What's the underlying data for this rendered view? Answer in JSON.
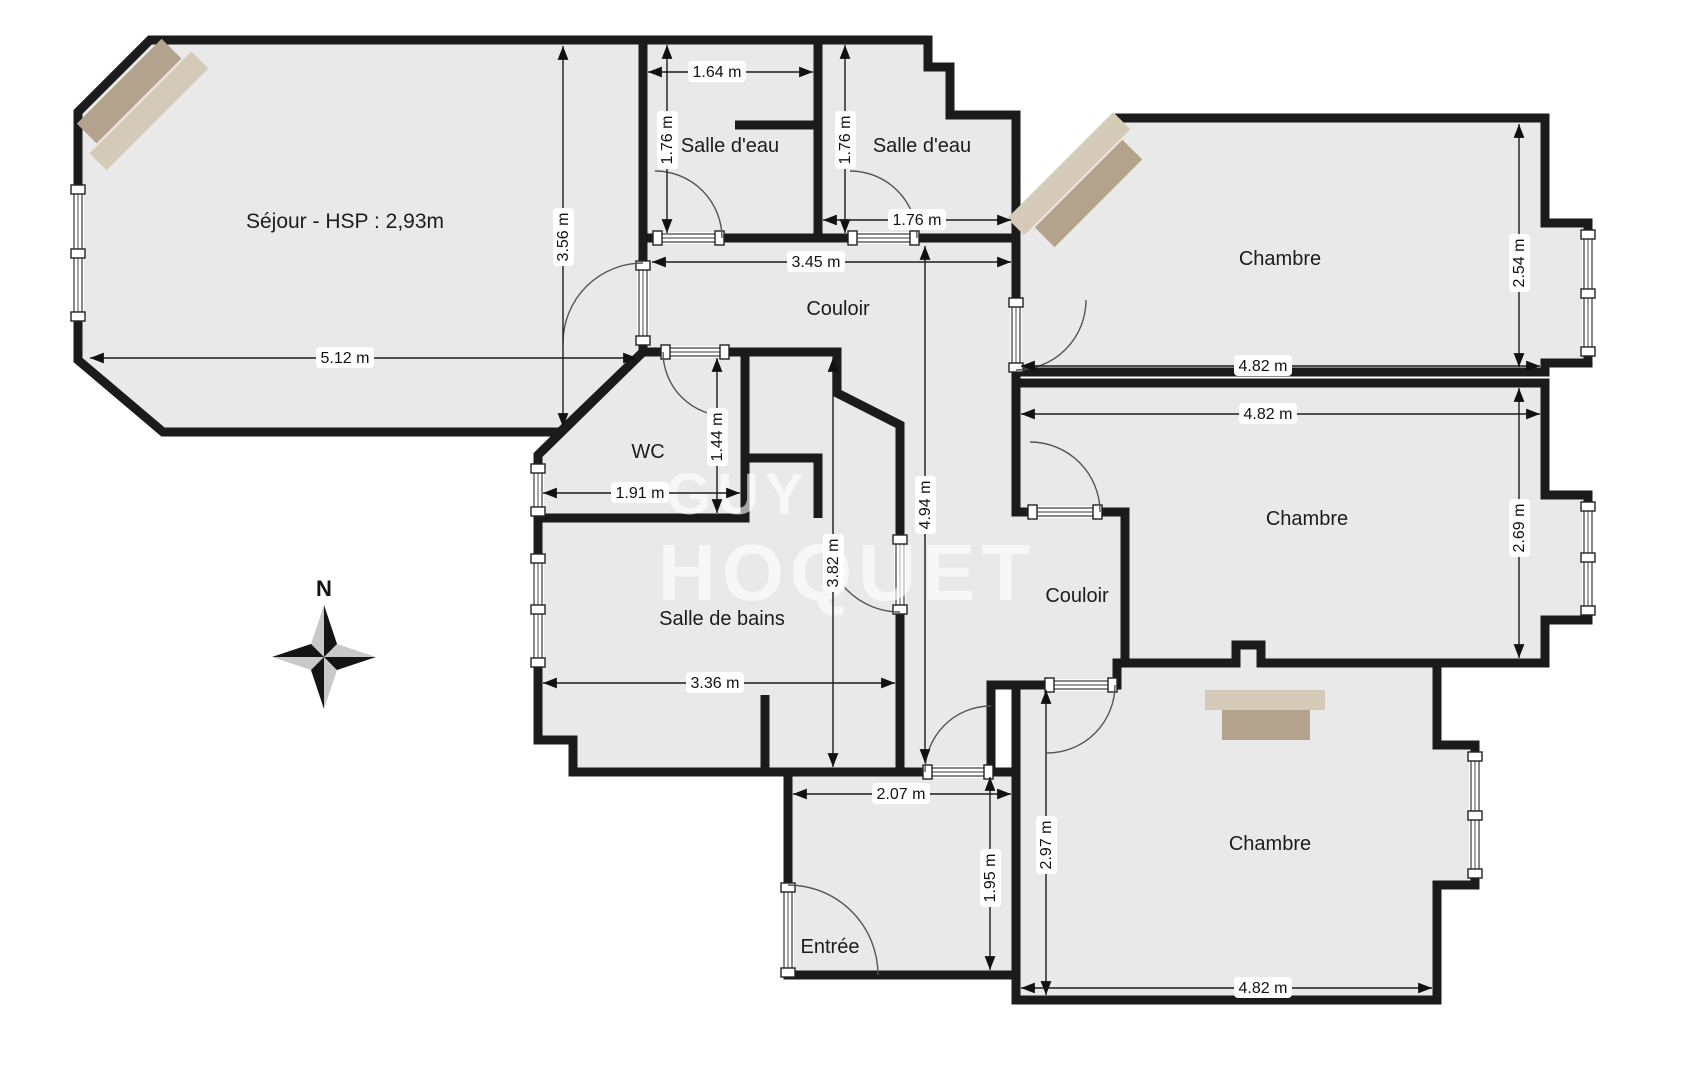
{
  "watermark": {
    "line1": "GUY",
    "line2": "HOQUET"
  },
  "compass": {
    "north": "N"
  },
  "rooms": [
    {
      "name": "sejour",
      "label": "Séjour - HSP : 2,93m"
    },
    {
      "name": "salle-deau-gauche",
      "label": "Salle d'eau"
    },
    {
      "name": "salle-deau-droite",
      "label": "Salle d'eau"
    },
    {
      "name": "chambre-haut",
      "label": "Chambre"
    },
    {
      "name": "couloir-haut",
      "label": "Couloir"
    },
    {
      "name": "wc",
      "label": "WC"
    },
    {
      "name": "salle-de-bains",
      "label": "Salle de bains"
    },
    {
      "name": "couloir-bas",
      "label": "Couloir"
    },
    {
      "name": "chambre-milieu",
      "label": "Chambre"
    },
    {
      "name": "chambre-bas",
      "label": "Chambre"
    },
    {
      "name": "entree",
      "label": "Entrée"
    }
  ],
  "dimensions": [
    {
      "label": "1.64 m"
    },
    {
      "label": "1.76 m"
    },
    {
      "label": "1.76 m"
    },
    {
      "label": "1.76 m"
    },
    {
      "label": "3.45 m"
    },
    {
      "label": "3.56 m"
    },
    {
      "label": "5.12 m"
    },
    {
      "label": "4.82 m"
    },
    {
      "label": "2.54 m"
    },
    {
      "label": "4.82 m"
    },
    {
      "label": "1.44 m"
    },
    {
      "label": "1.91 m"
    },
    {
      "label": "4.94 m"
    },
    {
      "label": "3.82 m"
    },
    {
      "label": "2.69 m"
    },
    {
      "label": "3.36 m"
    },
    {
      "label": "2.07 m"
    },
    {
      "label": "1.95 m"
    },
    {
      "label": "2.97 m"
    },
    {
      "label": "4.82 m"
    }
  ],
  "colors": {
    "floor": "#e9e9e9",
    "wall": "#1b1b1b",
    "furniture_light": "#d5cab8",
    "furniture_dark": "#b3a38c",
    "watermark": "rgba(255,255,255,0.62)"
  }
}
